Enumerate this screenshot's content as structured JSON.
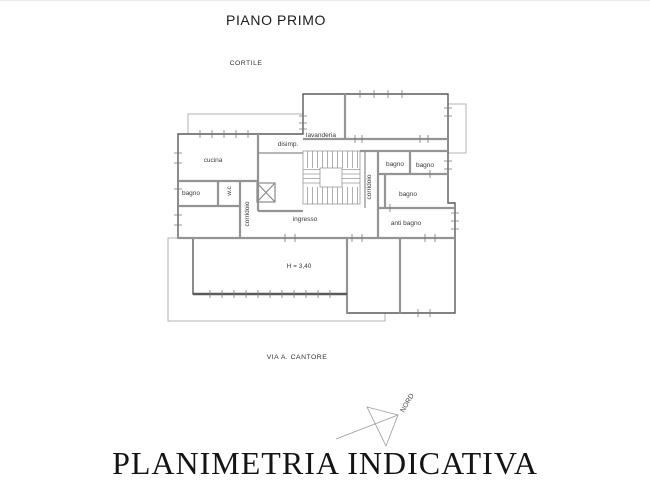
{
  "page": {
    "title": "PIANO PRIMO",
    "footer_title": "PLANIMETRIA INDICATIVA"
  },
  "context": {
    "courtyard_label": "CORTILE",
    "street_label": "VIA A. CANTORE",
    "north_label": "NORD"
  },
  "plan": {
    "labels": {
      "cucina": "cucina",
      "lavanderia": "lavanderia",
      "disimpegno": "disimp.",
      "bagno_left": "bagno",
      "wc": "w.c",
      "corridoio_left": "corridoio",
      "corridoio_right": "corridoio",
      "bagno_top_left": "bagno",
      "bagno_top_right": "bagno",
      "bagno_middle": "bagno",
      "anti_bagno": "anti bagno",
      "ingresso": "ingresso",
      "ceiling_height": "H = 3,40"
    },
    "colors": {
      "outer_wall": "#5a5a5a",
      "inner_wall": "#949494",
      "terrace_line": "#b3b3b3",
      "label_text": "#3a3a3a"
    }
  }
}
